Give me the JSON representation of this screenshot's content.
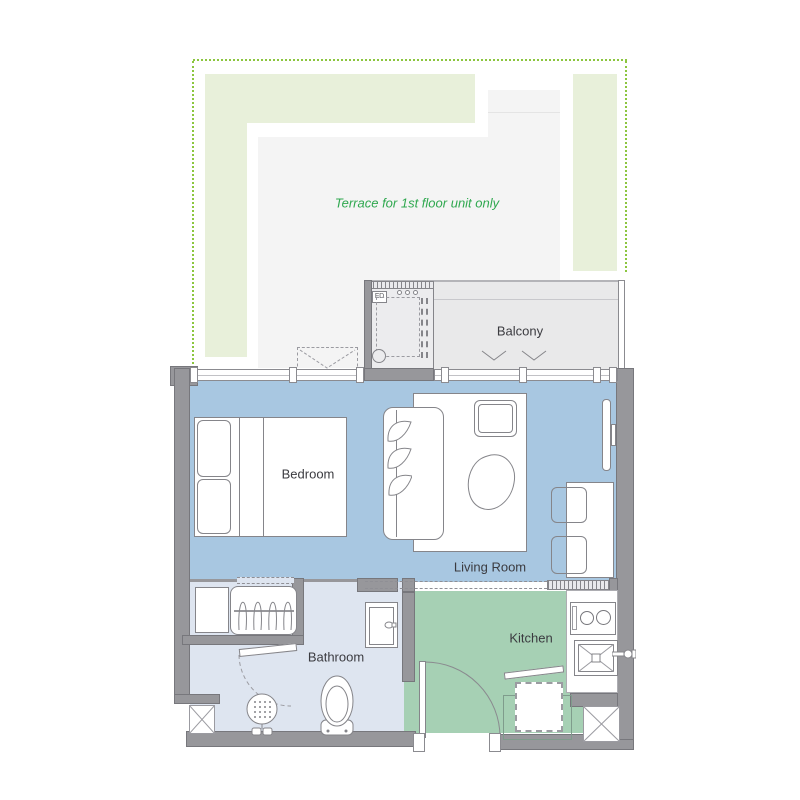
{
  "plan": {
    "terrace": {
      "note": "Terrace for 1st floor unit only"
    },
    "rooms": {
      "balcony": "Balcony",
      "bedroom": "Bedroom",
      "living_room": "Living Room",
      "bathroom": "Bathroom",
      "kitchen": "Kitchen"
    },
    "marks": {
      "floor_drain": "FD"
    },
    "colors": {
      "floor_main": "#a8c7e1",
      "floor_kitchen": "#a6d0b4",
      "floor_bathroom": "#dee5f0",
      "floor_balcony": "#e9e9ea",
      "floor_terrace": "#f4f4f4",
      "garden_strip": "#e8f0da",
      "wall": "#97979b",
      "terrace_outline_green": "#8cc63f",
      "terrace_text_green": "#2fa84f"
    }
  }
}
